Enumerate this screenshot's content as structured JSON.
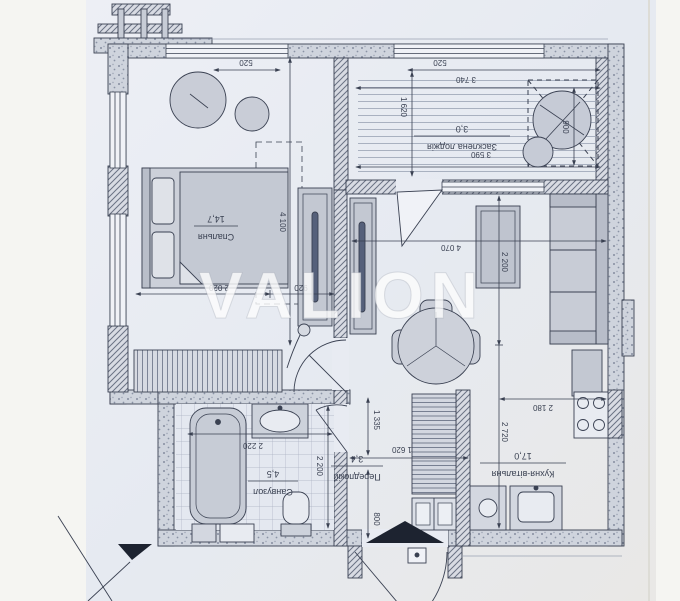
{
  "watermark": "VALION",
  "plan_title": "apartment-floor-plan",
  "rooms": {
    "bedroom": {
      "name": "Спальня",
      "area": "14,7"
    },
    "kitchen_living": {
      "name": "Кухня-вітальня",
      "area": "17,0"
    },
    "bathroom": {
      "name": "Санвузол",
      "area": "4,5"
    },
    "hallway": {
      "name": "Передпокій",
      "area": "3,4"
    },
    "loggia": {
      "name": "Засклена лоджія",
      "area": "3,0"
    }
  },
  "dimensions_mm": {
    "bedroom_window": "520",
    "loggia_window": "520",
    "loggia_width_top": "3 740",
    "loggia_depth": "1 620",
    "loggia_width_bottom": "3 590",
    "loggia_plant_zone": "900",
    "bedroom_length": "4 100",
    "bedroom_width": "2 020",
    "bedroom_door": "920",
    "living_width": "4 070",
    "living_depth": "2 200",
    "kitchen_depth": "2 720",
    "kitchen_width": "2 180",
    "bathroom_width": "2 220",
    "bathroom_depth": "2 200",
    "hallway_width": "1 620",
    "hallway_depth_upper": "1 335",
    "hallway_depth_lower": "800"
  },
  "colors": {
    "paper": "#e8ebf2",
    "ink": "#3a4152",
    "furniture": "#cdd1da",
    "wall_fill": "#d8dbe3",
    "watermark": "#fdfdfd"
  }
}
